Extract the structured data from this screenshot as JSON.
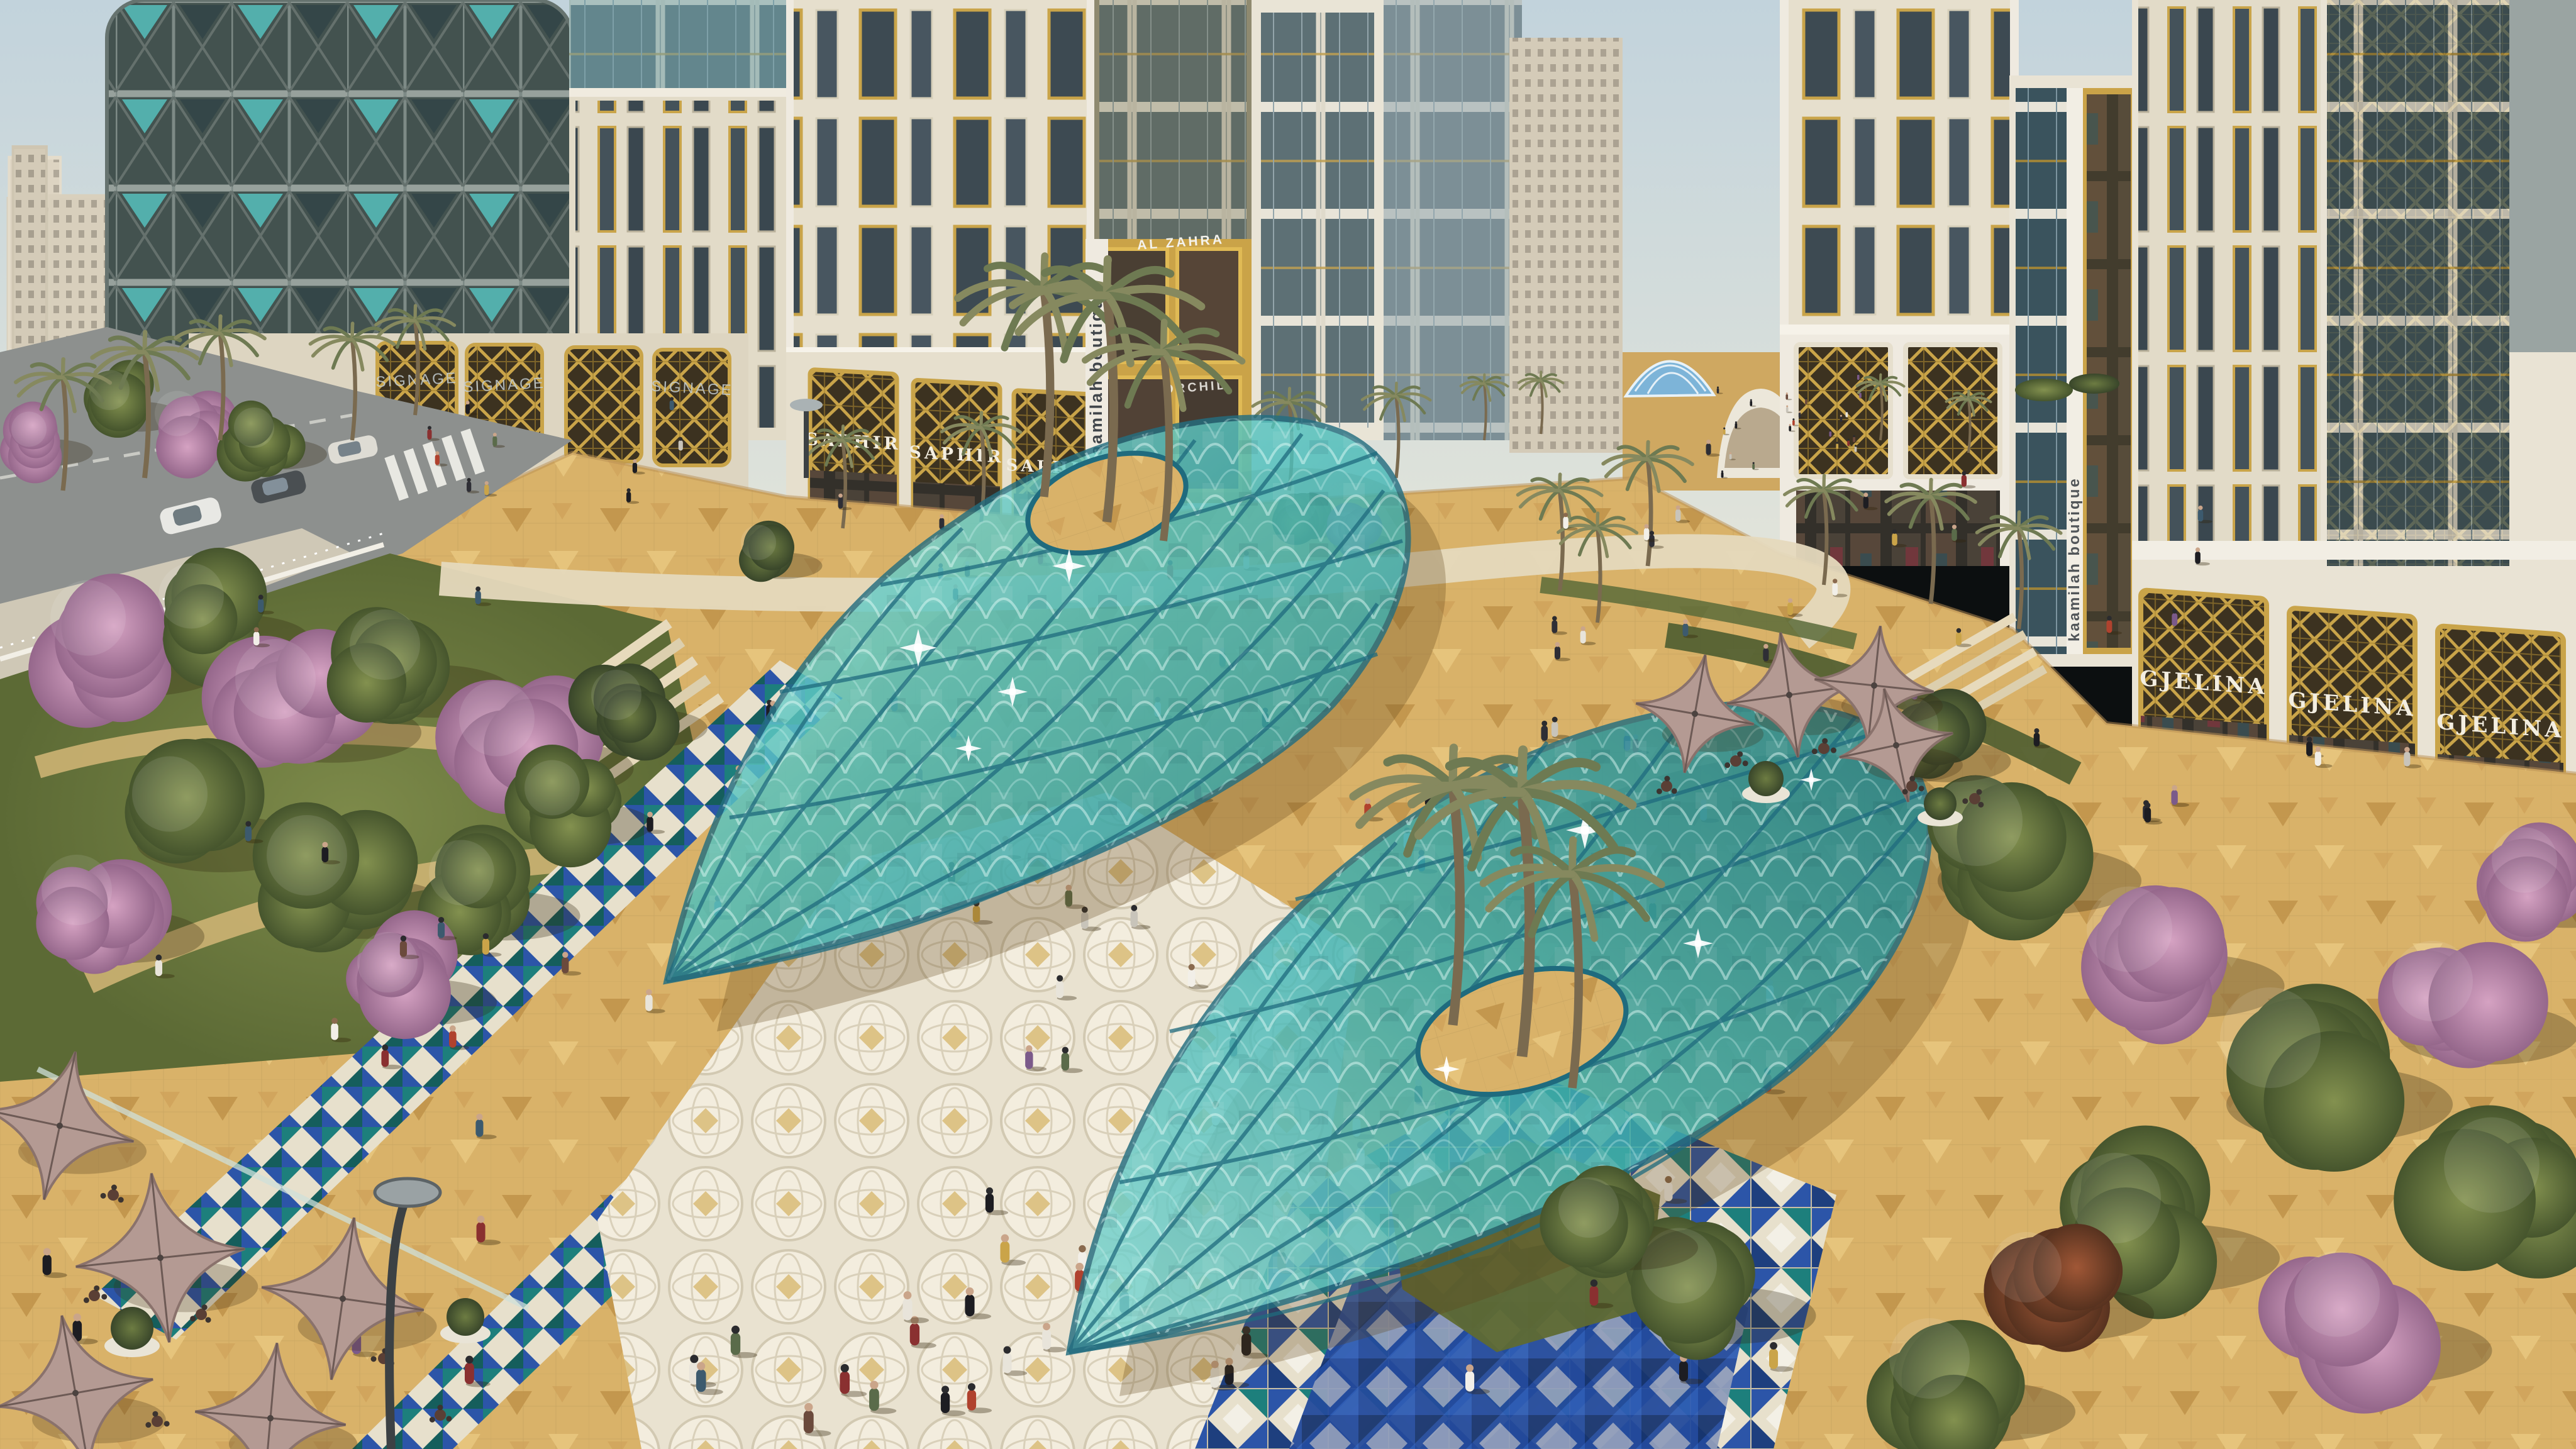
{
  "signs": {
    "saphir": {
      "label": "SAPHIR",
      "count": 3
    },
    "gjelina": {
      "label": "GJELINA",
      "count": 3
    },
    "signage_placeholder": {
      "label": "SIGNAGE",
      "count": 3
    },
    "kaamilah": {
      "label": "kaamilah boutique",
      "count": 2
    },
    "al_zahra": {
      "label": "AL ZAHRA",
      "count": 1
    },
    "orchid": {
      "label": "ORCHID",
      "count": 1
    }
  },
  "colors": {
    "sky": "#c2d3dc",
    "canopy_teal": "#4fc0bd",
    "canopy_deep": "#1e8e95",
    "canopy_edge": "#246e80",
    "paving_sand": "#d9b269",
    "paving_cream": "#e9e2d0",
    "mosaic_blue": "#2c55a8",
    "mosaic_navy": "#234a9c",
    "mosaic_teal": "#1d7f7c",
    "facade_cream": "#e6dfcd",
    "facade_white": "#efeae0",
    "gold_frame": "#c9a449",
    "glass_dark": "#3d4a52",
    "umbrella_mauve": "#b49a93",
    "tree_green": "#55693a",
    "tree_pink": "#bc85a8",
    "road_grey": "#8d908e",
    "lawn_green": "#6c7a40"
  }
}
